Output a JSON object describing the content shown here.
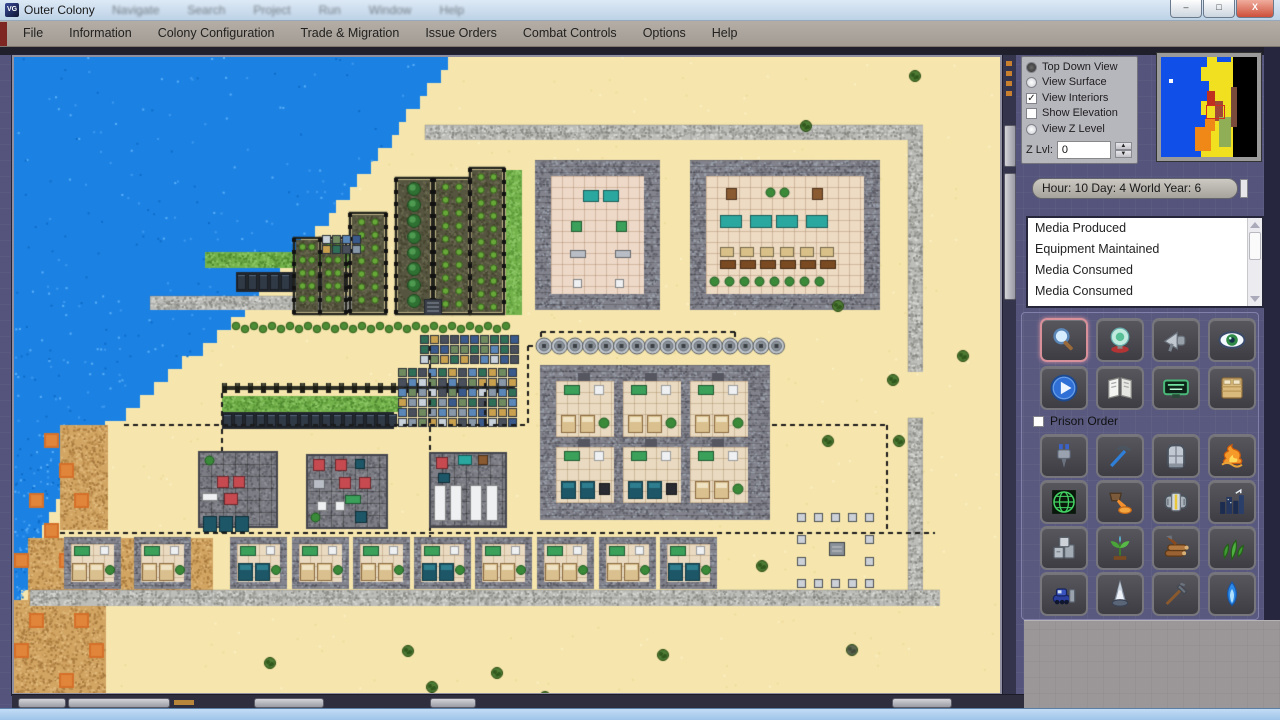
{
  "window": {
    "title": "Outer Colony",
    "ghost_menu": [
      "Navigate",
      "Search",
      "Project",
      "Run",
      "Window",
      "Help"
    ],
    "controls": [
      {
        "id": "minimize",
        "glyph": "–"
      },
      {
        "id": "maximize",
        "glyph": "□"
      },
      {
        "id": "close",
        "glyph": "X"
      }
    ]
  },
  "menu_bar": {
    "items": [
      "File",
      "Information",
      "Colony Configuration",
      "Trade & Migration",
      "Issue Orders",
      "Combat Controls",
      "Options",
      "Help"
    ]
  },
  "view_panel": {
    "options": [
      {
        "label": "Top Down View",
        "kind": "radio",
        "checked": true
      },
      {
        "label": "View Surface",
        "kind": "radio",
        "checked": false
      },
      {
        "label": "View Interiors",
        "kind": "checkbox",
        "checked": true
      },
      {
        "label": "Show Elevation",
        "kind": "checkbox",
        "checked": false
      },
      {
        "label": "View Z Level",
        "kind": "radio",
        "checked": false
      }
    ],
    "z_label": "Z Lvl:",
    "z_value": "0"
  },
  "time_bar": {
    "text": "Hour: 10 Day: 4 World Year: 6"
  },
  "event_list": {
    "items": [
      "Media Produced",
      "Equipment Maintained",
      "Media Consumed",
      "Media Consumed"
    ]
  },
  "tools": {
    "primary": [
      {
        "icon": "magnifier",
        "selected": true
      },
      {
        "icon": "crystal-ball",
        "selected": false
      },
      {
        "icon": "megaphone",
        "selected": false
      },
      {
        "icon": "eye",
        "selected": false
      },
      {
        "icon": "play",
        "selected": false
      },
      {
        "icon": "book",
        "selected": false
      },
      {
        "icon": "neon-sign",
        "selected": false
      },
      {
        "icon": "bed",
        "selected": false
      }
    ],
    "prison_order_label": "Prison Order",
    "orders": [
      {
        "icon": "drill"
      },
      {
        "icon": "pickaxe"
      },
      {
        "icon": "door"
      },
      {
        "icon": "fire"
      },
      {
        "icon": "globe-grid"
      },
      {
        "icon": "crucible"
      },
      {
        "icon": "engine"
      },
      {
        "icon": "city"
      },
      {
        "icon": "stone"
      },
      {
        "icon": "sprout"
      },
      {
        "icon": "logs"
      },
      {
        "icon": "herb"
      },
      {
        "icon": "bulldozer"
      },
      {
        "icon": "cone"
      },
      {
        "icon": "rake"
      },
      {
        "icon": "blue-flame"
      }
    ]
  },
  "minimap": {
    "regions": [
      {
        "x": 0,
        "y": 0,
        "w": 96,
        "h": 100,
        "c": "#000000"
      },
      {
        "x": 30,
        "y": 0,
        "w": 42,
        "h": 100,
        "c": "#f0e020"
      },
      {
        "x": 0,
        "y": 0,
        "w": 40,
        "h": 100,
        "c": "#1050e8"
      },
      {
        "x": 40,
        "y": 0,
        "w": 6,
        "h": 10,
        "c": "#1050e8"
      },
      {
        "x": 40,
        "y": 24,
        "w": 8,
        "h": 20,
        "c": "#1050e8"
      },
      {
        "x": 40,
        "y": 58,
        "w": 5,
        "h": 26,
        "c": "#1050e8"
      },
      {
        "x": 56,
        "y": 0,
        "w": 14,
        "h": 5,
        "c": "#1050e8"
      },
      {
        "x": 64,
        "y": 14,
        "w": 8,
        "h": 30,
        "c": "#f0e020"
      },
      {
        "x": 34,
        "y": 70,
        "w": 16,
        "h": 24,
        "c": "#f08818"
      },
      {
        "x": 44,
        "y": 62,
        "w": 10,
        "h": 12,
        "c": "#f08818"
      },
      {
        "x": 46,
        "y": 34,
        "w": 8,
        "h": 14,
        "c": "#c03020"
      },
      {
        "x": 54,
        "y": 44,
        "w": 8,
        "h": 20,
        "c": "#a04838"
      },
      {
        "x": 58,
        "y": 60,
        "w": 12,
        "h": 30,
        "c": "#8fae56"
      },
      {
        "x": 70,
        "y": 30,
        "w": 6,
        "h": 40,
        "c": "#7a4a3a"
      },
      {
        "x": 8,
        "y": 22,
        "w": 4,
        "h": 4,
        "c": "#ffffff"
      }
    ],
    "viewport": {
      "x": 45,
      "y": 48,
      "w": 17,
      "h": 12
    }
  },
  "map": {
    "sand": "#f6e6ad",
    "water": {
      "color": "#1b82e4",
      "dots": [
        "#3f9af0",
        "#0f6cc8",
        "#5cb0f8"
      ],
      "anchors": [
        [
          441,
          0
        ],
        [
          391,
          63
        ],
        [
          336,
          133
        ],
        [
          286,
          193
        ],
        [
          241,
          243
        ],
        [
          191,
          288
        ],
        [
          136,
          333
        ],
        [
          96,
          368
        ],
        [
          61,
          413
        ],
        [
          36,
          453
        ],
        [
          16,
          503
        ],
        [
          2,
          590
        ]
      ]
    },
    "dirt": [
      [
        46,
        368,
        48,
        105
      ],
      [
        14,
        481,
        185,
        62
      ],
      [
        0,
        543,
        92,
        95
      ],
      [
        91,
        503,
        60,
        45
      ]
    ],
    "orange": [
      [
        30,
        376
      ],
      [
        45,
        406
      ],
      [
        15,
        436
      ],
      [
        60,
        436
      ],
      [
        30,
        466
      ],
      [
        0,
        496
      ],
      [
        45,
        496
      ],
      [
        89,
        526
      ],
      [
        15,
        556
      ],
      [
        60,
        556
      ],
      [
        0,
        586
      ],
      [
        45,
        616
      ],
      [
        75,
        586
      ]
    ],
    "walls": [
      [
        411,
        68,
        498,
        15
      ],
      [
        894,
        83,
        15,
        232
      ],
      [
        894,
        361,
        15,
        176
      ],
      [
        16,
        533,
        910,
        16
      ],
      [
        136,
        239,
        214,
        14
      ]
    ],
    "farm_cols": [
      {
        "x": 338,
        "y": 158,
        "w": 32,
        "h": 97,
        "kind": "crops"
      },
      {
        "x": 384,
        "y": 123,
        "w": 32,
        "h": 132,
        "kind": "trees"
      },
      {
        "x": 422,
        "y": 123,
        "w": 32,
        "h": 132,
        "kind": "crops"
      },
      {
        "x": 458,
        "y": 113,
        "w": 30,
        "h": 142,
        "kind": "crops"
      },
      {
        "x": 492,
        "y": 113,
        "w": 16,
        "h": 145,
        "kind": "grass"
      },
      {
        "x": 282,
        "y": 183,
        "w": 22,
        "h": 72,
        "kind": "crops"
      },
      {
        "x": 308,
        "y": 183,
        "w": 22,
        "h": 72,
        "kind": "crops"
      }
    ],
    "hedges": [
      [
        218,
        263,
        283,
        14
      ]
    ],
    "fences": [
      [
        208,
        326,
        293,
        10
      ]
    ],
    "grass": [
      [
        208,
        339,
        180,
        16
      ],
      [
        191,
        195,
        145,
        16
      ]
    ],
    "solar": [
      [
        208,
        355,
        172,
        17
      ],
      [
        222,
        215,
        112,
        20
      ]
    ],
    "tech": [
      [
        384,
        311,
        114,
        60
      ],
      [
        406,
        278,
        96,
        27
      ],
      [
        308,
        178,
        42,
        22
      ]
    ],
    "dark_tiles": [
      [
        410,
        242,
        18,
        16
      ]
    ],
    "paths": [
      [
        110,
        368,
        512,
        368
      ],
      [
        758,
        368,
        873,
        368
      ],
      [
        46,
        476,
        921,
        476
      ],
      [
        514,
        289,
        758,
        289
      ],
      [
        527,
        275,
        721,
        275
      ],
      [
        208,
        336,
        208,
        476
      ],
      [
        416,
        289,
        416,
        503
      ],
      [
        471,
        326,
        471,
        368
      ],
      [
        514,
        289,
        514,
        368
      ],
      [
        527,
        275,
        527,
        289
      ],
      [
        721,
        275,
        721,
        289
      ],
      [
        873,
        368,
        873,
        476
      ]
    ],
    "lamps": {
      "x0": 530,
      "y": 289,
      "n": 16,
      "spacing": 15.5,
      "r": 8
    },
    "halls": [
      {
        "x": 521,
        "y": 103,
        "w": 125,
        "h": 150,
        "floor": "#eed9c8",
        "items": [
          [
            569,
            133,
            16,
            12,
            "teal"
          ],
          [
            589,
            133,
            16,
            12,
            "teal"
          ],
          [
            557,
            164,
            11,
            11,
            "green"
          ],
          [
            602,
            164,
            11,
            11,
            "green"
          ],
          [
            556,
            193,
            16,
            8,
            "grey"
          ],
          [
            601,
            193,
            16,
            8,
            "grey"
          ],
          [
            559,
            222,
            9,
            9,
            "white"
          ],
          [
            601,
            222,
            9,
            9,
            "white"
          ]
        ]
      },
      {
        "x": 676,
        "y": 103,
        "w": 190,
        "h": 150,
        "floor": "#eddbc4",
        "items": [
          [
            712,
            131,
            11,
            12,
            "brown"
          ],
          [
            798,
            131,
            11,
            12,
            "brown"
          ],
          [
            752,
            131,
            9,
            9,
            "plant"
          ],
          [
            766,
            131,
            9,
            9,
            "plant"
          ],
          [
            706,
            158,
            22,
            13,
            "teal"
          ],
          [
            736,
            158,
            22,
            13,
            "teal"
          ],
          [
            762,
            158,
            22,
            13,
            "teal"
          ],
          [
            792,
            158,
            22,
            13,
            "teal"
          ],
          [
            706,
            190,
            14,
            10,
            "bench"
          ],
          [
            726,
            190,
            14,
            10,
            "bench"
          ],
          [
            746,
            190,
            14,
            10,
            "bench"
          ],
          [
            766,
            190,
            14,
            10,
            "bench"
          ],
          [
            786,
            190,
            14,
            10,
            "bench"
          ],
          [
            806,
            190,
            14,
            10,
            "bench"
          ],
          [
            706,
            203,
            16,
            9,
            "table"
          ],
          [
            726,
            203,
            16,
            9,
            "table"
          ],
          [
            746,
            203,
            16,
            9,
            "table"
          ],
          [
            766,
            203,
            16,
            9,
            "table"
          ],
          [
            786,
            203,
            16,
            9,
            "table"
          ],
          [
            806,
            203,
            16,
            9,
            "table"
          ],
          [
            696,
            220,
            9,
            9,
            "plant"
          ],
          [
            711,
            220,
            9,
            9,
            "plant"
          ],
          [
            726,
            220,
            9,
            9,
            "plant"
          ],
          [
            741,
            220,
            9,
            9,
            "plant"
          ],
          [
            756,
            220,
            9,
            9,
            "plant"
          ],
          [
            771,
            220,
            9,
            9,
            "plant"
          ],
          [
            786,
            220,
            9,
            9,
            "plant"
          ],
          [
            801,
            220,
            9,
            9,
            "plant"
          ]
        ]
      }
    ],
    "dorm": {
      "x": 526,
      "y": 308,
      "w": 230,
      "h": 155,
      "room_w": 58,
      "room_h": 56,
      "cols": [
        542,
        609,
        676
      ],
      "rows": [
        324,
        390
      ],
      "beds": [
        "tan",
        "tan",
        "tan",
        "dark",
        "dark",
        "tan"
      ]
    },
    "workshops": [
      {
        "x": 185,
        "y": 395,
        "w": 78,
        "h": 75,
        "items": [
          [
            191,
            399,
            9,
            9,
            "plant"
          ],
          [
            203,
            419,
            12,
            12,
            "red"
          ],
          [
            219,
            419,
            12,
            12,
            "red"
          ],
          [
            188,
            436,
            16,
            8,
            "white"
          ],
          [
            210,
            436,
            14,
            12,
            "red"
          ],
          [
            189,
            459,
            14,
            16,
            "dark"
          ],
          [
            205,
            459,
            14,
            16,
            "dark"
          ],
          [
            221,
            459,
            14,
            16,
            "dark"
          ]
        ]
      },
      {
        "x": 293,
        "y": 398,
        "w": 80,
        "h": 73,
        "items": [
          [
            299,
            402,
            12,
            12,
            "red"
          ],
          [
            321,
            402,
            12,
            12,
            "red"
          ],
          [
            341,
            402,
            10,
            10,
            "dark"
          ],
          [
            325,
            420,
            12,
            12,
            "red"
          ],
          [
            345,
            420,
            12,
            12,
            "red"
          ],
          [
            299,
            422,
            12,
            10,
            "grey"
          ],
          [
            331,
            438,
            16,
            9,
            "green"
          ],
          [
            303,
            444,
            10,
            10,
            "white"
          ],
          [
            321,
            444,
            10,
            10,
            "white"
          ],
          [
            297,
            456,
            9,
            9,
            "plant"
          ],
          [
            341,
            454,
            12,
            12,
            "dark"
          ]
        ]
      },
      {
        "x": 416,
        "y": 396,
        "w": 76,
        "h": 74,
        "items": [
          [
            422,
            400,
            12,
            12,
            "red"
          ],
          [
            444,
            398,
            14,
            10,
            "teal"
          ],
          [
            464,
            398,
            10,
            10,
            "brown"
          ],
          [
            424,
            416,
            12,
            10,
            "dark"
          ],
          [
            420,
            428,
            12,
            36,
            "white"
          ],
          [
            436,
            428,
            12,
            36,
            "white"
          ],
          [
            456,
            428,
            12,
            36,
            "white"
          ],
          [
            472,
            428,
            12,
            36,
            "white"
          ]
        ]
      }
    ],
    "rooms": {
      "y": 480,
      "w": 57,
      "h": 52,
      "xs": [
        50,
        120,
        216,
        278,
        339,
        400,
        461,
        523,
        585,
        646
      ],
      "beds": [
        "tan",
        "tan",
        "dark",
        "tan",
        "tan",
        "dark",
        "tan",
        "tan",
        "tan",
        "dark"
      ]
    },
    "chairs": {
      "size": 9,
      "center": [
        815,
        485,
        16,
        14
      ],
      "squares": [
        [
          783,
          456
        ],
        [
          800,
          456
        ],
        [
          817,
          456
        ],
        [
          834,
          456
        ],
        [
          851,
          456
        ],
        [
          783,
          522
        ],
        [
          800,
          522
        ],
        [
          817,
          522
        ],
        [
          834,
          522
        ],
        [
          851,
          522
        ],
        [
          783,
          478
        ],
        [
          783,
          500
        ],
        [
          851,
          478
        ],
        [
          851,
          500
        ]
      ]
    },
    "bushes": [
      [
        901,
        19
      ],
      [
        792,
        69
      ],
      [
        824,
        249
      ],
      [
        879,
        323
      ],
      [
        949,
        299
      ],
      [
        814,
        384
      ],
      [
        885,
        384
      ],
      [
        748,
        509
      ],
      [
        256,
        606
      ],
      [
        394,
        594
      ],
      [
        483,
        616
      ],
      [
        649,
        598
      ],
      [
        418,
        630
      ],
      [
        531,
        640
      ]
    ],
    "dark_bushes": [
      [
        838,
        593
      ]
    ]
  }
}
